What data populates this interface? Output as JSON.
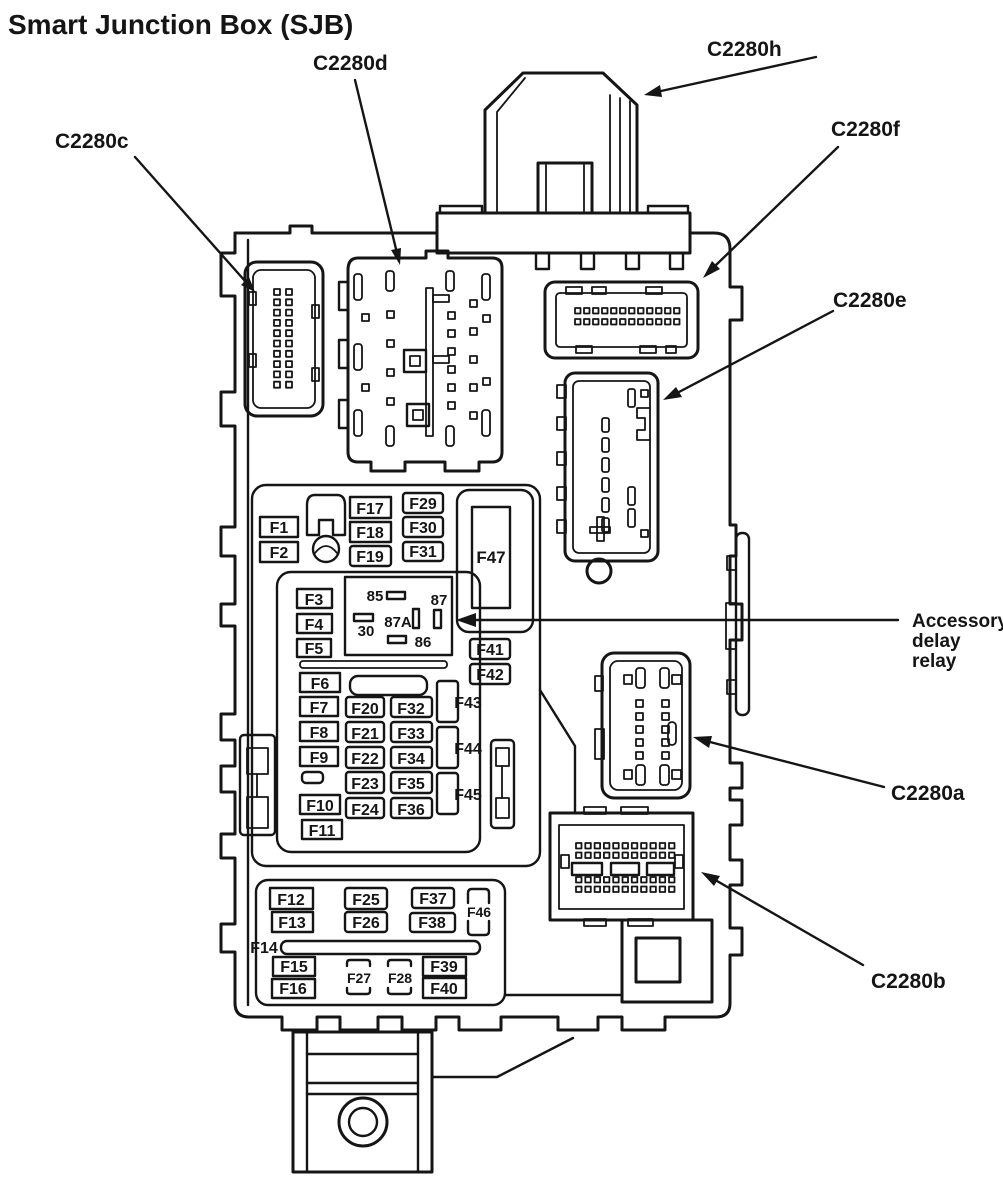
{
  "title": "Smart Junction Box (SJB)",
  "connectors": {
    "c2280c": "C2280c",
    "c2280d": "C2280d",
    "c2280h": "C2280h",
    "c2280f": "C2280f",
    "c2280e": "C2280e",
    "c2280a": "C2280a",
    "c2280b": "C2280b"
  },
  "relay": {
    "label_line1": "Accessory",
    "label_line2": "delay",
    "label_line3": "relay",
    "pin85": "85",
    "pin30": "30",
    "pin87": "87",
    "pin87a": "87A",
    "pin86": "86"
  },
  "fuses": {
    "f1": "F1",
    "f2": "F2",
    "f3": "F3",
    "f4": "F4",
    "f5": "F5",
    "f6": "F6",
    "f7": "F7",
    "f8": "F8",
    "f9": "F9",
    "f10": "F10",
    "f11": "F11",
    "f12": "F12",
    "f13": "F13",
    "f14": "F14",
    "f15": "F15",
    "f16": "F16",
    "f17": "F17",
    "f18": "F18",
    "f19": "F19",
    "f20": "F20",
    "f21": "F21",
    "f22": "F22",
    "f23": "F23",
    "f24": "F24",
    "f25": "F25",
    "f26": "F26",
    "f27": "F27",
    "f28": "F28",
    "f29": "F29",
    "f30": "F30",
    "f31": "F31",
    "f32": "F32",
    "f33": "F33",
    "f34": "F34",
    "f35": "F35",
    "f36": "F36",
    "f37": "F37",
    "f38": "F38",
    "f39": "F39",
    "f40": "F40",
    "f41": "F41",
    "f42": "F42",
    "f43": "F43",
    "f44": "F44",
    "f45": "F45",
    "f46": "F46",
    "f47": "F47"
  }
}
